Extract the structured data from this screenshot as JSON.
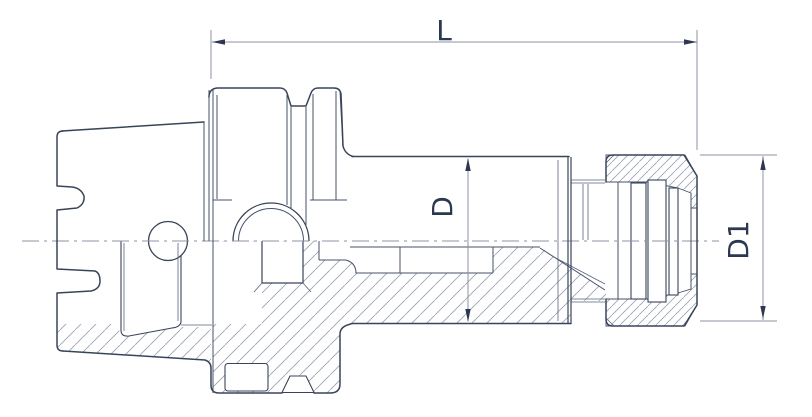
{
  "drawing": {
    "kind_label": "technical-drawing",
    "dimensions": {
      "length": {
        "label": "L",
        "orientation": "horizontal"
      },
      "diameter_d": {
        "label": "D",
        "orientation": "vertical"
      },
      "diameter_d1": {
        "label": "D1",
        "orientation": "vertical"
      }
    },
    "colors": {
      "background": "#ffffff",
      "outline": "#39445a",
      "internal_lines": "#46516a",
      "hatch": "#9aa2b2",
      "dimension_lines": "#8c93a3",
      "label_text": "#2c3850"
    }
  }
}
